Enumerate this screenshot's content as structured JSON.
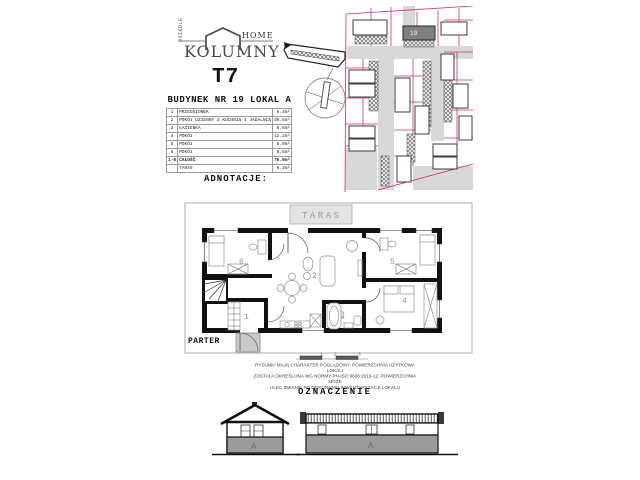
{
  "header": {
    "logo": {
      "estate": "OSIEDLE",
      "home": "HOME",
      "name": "KOLUMNY"
    },
    "unit_code": "T7",
    "building_title": "BUDYNEK NR 19 LOKAL A",
    "annotations_label": "ADNOTACJE:"
  },
  "rooms_table": {
    "rows": [
      {
        "no": "1",
        "name": "PRZEDSIONEK",
        "area": "6.3m²"
      },
      {
        "no": "2",
        "name": "POKÓJ DZIENNY Z KUCHNIĄ I JADALNIĄ",
        "area": "30.5m²"
      },
      {
        "no": "3",
        "name": "ŁAZIENKA",
        "area": "6.6m²"
      },
      {
        "no": "4",
        "name": "POKÓJ",
        "area": "12.2m²"
      },
      {
        "no": "5",
        "name": "POKÓJ",
        "area": "8.9m²"
      },
      {
        "no": "6",
        "name": "POKÓJ",
        "area": "8.5m²"
      },
      {
        "no": "1-6",
        "name": "CAŁOŚĆ",
        "area": "76.9m²"
      },
      {
        "no": "",
        "name": "TARAS",
        "area": "6.3m²"
      }
    ]
  },
  "site_plan": {
    "highlighted_building": "19"
  },
  "floor_plan": {
    "terrace_label": "TARAS",
    "floor_label": "PARTER",
    "room_numbers": [
      "1",
      "2",
      "3",
      "4",
      "5",
      "6"
    ]
  },
  "scale_bar": {
    "labels": [
      "1",
      "2",
      "3"
    ]
  },
  "disclaimer": {
    "line1": "RYSUNKI MAJĄ CHARAKTER POGLĄDOWY. POWIERZCHNIA UŻYTKOWA LOKALI",
    "line2": "ZOSTAŁA OKREŚLONA WG NORMY PN-ISO 9836:2015-12. POWIERZCHNIA MOŻE",
    "line3": "ULEC ZMIANIE PO DOKONANIU INWENTARYZACJI LOKALU"
  },
  "legend": {
    "title": "OZNACZENIE",
    "marker": "A"
  },
  "colors": {
    "plot_line": "#cc2e7c",
    "highlight_gray": "#7f7f7f",
    "band_gray": "#9b9b9b"
  }
}
